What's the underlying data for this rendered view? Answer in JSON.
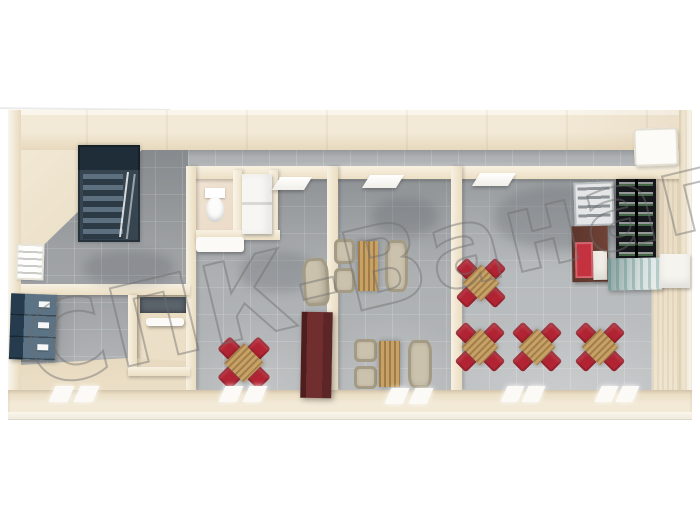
{
  "watermark": {
    "text": "СПК-Ванап"
  },
  "palette": {
    "wall": "#f2e9d6",
    "wallShade": "#e7d9bd",
    "wallRim": "#faf6ec",
    "floor": "#aaadaf",
    "floorDark": "#9b9ea1",
    "floorLight": "#b5b8ba",
    "bath": "#e8d6c2",
    "beigeFloor": "#ecdfc7",
    "stair": "#36454f",
    "stairStep": "#5d7080",
    "locker": "#5b7384",
    "lockerDark": "#263b4d",
    "red": "#b22433",
    "wood": "#c7a267",
    "beige": "#cbc2ad",
    "beigeDark": "#a49b84",
    "cabinet": "#702f2e",
    "shelfDark": "#17181c",
    "fridge": "#e4e6e7",
    "brown": "#6f4236",
    "counter": "#a9bcb9",
    "watermark": "#6e6e6e"
  },
  "scene": {
    "items": [
      {
        "type": "shadow",
        "name": "floor-shadow",
        "x": 495,
        "y": 186,
        "w": 150,
        "h": 64
      },
      {
        "type": "shadow",
        "name": "floor-shadow",
        "x": 372,
        "y": 198,
        "w": 66,
        "h": 38
      },
      {
        "type": "shadow",
        "name": "floor-shadow",
        "x": 240,
        "y": 252,
        "w": 76,
        "h": 40
      },
      {
        "type": "shadow",
        "name": "floor-shadow",
        "x": 84,
        "y": 250,
        "w": 90,
        "h": 36
      },
      {
        "type": "stairs",
        "name": "staircase",
        "x": 78,
        "y": 145,
        "w": 62,
        "h": 97
      },
      {
        "type": "lockers",
        "name": "locker-cabinet",
        "x": 10,
        "y": 294,
        "w": 46,
        "h": 66,
        "t": "rotate(2deg)"
      },
      {
        "type": "window-blinds",
        "name": "left-wall-window",
        "x": 16,
        "y": 244,
        "w": 28,
        "h": 36,
        "t": "rotate(2deg)"
      },
      {
        "type": "mat-dark",
        "name": "vestibule-mat",
        "x": 140,
        "y": 297,
        "w": 46,
        "h": 16
      },
      {
        "type": "bath-counter",
        "name": "vestibule-shelf",
        "x": 146,
        "y": 318,
        "w": 38,
        "h": 8
      },
      {
        "type": "toilet",
        "name": "toilet",
        "x": 204,
        "y": 188,
        "w": 22,
        "h": 34
      },
      {
        "type": "sink-cabinet",
        "name": "washbasin-cabinet",
        "x": 242,
        "y": 174,
        "w": 30,
        "h": 60
      },
      {
        "type": "bath-counter",
        "name": "washroom-counter",
        "x": 196,
        "y": 237,
        "w": 48,
        "h": 15
      },
      {
        "type": "dining-set-red",
        "name": "dining-table-red",
        "x": 215,
        "y": 334,
        "w": 58,
        "h": 58,
        "t": "rotate(45deg)"
      },
      {
        "type": "armchair-beige",
        "name": "armchair",
        "x": 303,
        "y": 258,
        "w": 26,
        "h": 48,
        "t": "rotate(-3deg)"
      },
      {
        "type": "cabinet-red",
        "name": "tall-cabinet",
        "x": 301,
        "y": 312,
        "w": 31,
        "h": 86,
        "t": "rotate(1deg)"
      },
      {
        "type": "dinette",
        "name": "booth-dining-set",
        "x": 334,
        "y": 238,
        "w": 74,
        "h": 56
      },
      {
        "type": "dinette",
        "name": "booth-dining-set",
        "x": 354,
        "y": 338,
        "w": 78,
        "h": 52
      },
      {
        "type": "dining-set-red",
        "name": "dining-table-red",
        "x": 453,
        "y": 255,
        "w": 56,
        "h": 56,
        "t": "rotate(45deg)"
      },
      {
        "type": "dining-set-red",
        "name": "dining-table-red",
        "x": 452,
        "y": 319,
        "w": 56,
        "h": 56,
        "t": "rotate(45deg)"
      },
      {
        "type": "dining-set-red",
        "name": "dining-table-red",
        "x": 509,
        "y": 319,
        "w": 56,
        "h": 56,
        "t": "rotate(45deg)"
      },
      {
        "type": "dining-set-red",
        "name": "dining-table-red",
        "x": 572,
        "y": 319,
        "w": 56,
        "h": 56,
        "t": "rotate(45deg)"
      },
      {
        "type": "fridge-display",
        "name": "drinks-display",
        "x": 574,
        "y": 182,
        "w": 40,
        "h": 44,
        "t": "rotate(-2deg)"
      },
      {
        "type": "shelf-dark",
        "name": "retail-shelf",
        "x": 616,
        "y": 179,
        "w": 40,
        "h": 84
      },
      {
        "type": "shelf-brown",
        "name": "storage-shelf",
        "x": 572,
        "y": 226,
        "w": 36,
        "h": 56,
        "t": "rotate(-1deg)"
      },
      {
        "type": "counter-teal",
        "name": "serving-counter",
        "x": 608,
        "y": 258,
        "w": 54,
        "h": 32,
        "t": "rotate(-1deg)"
      },
      {
        "type": "box-white",
        "name": "counter-block",
        "x": 660,
        "y": 254,
        "w": 30,
        "h": 34
      },
      {
        "type": "ac-panel",
        "name": "wall-panel",
        "x": 634,
        "y": 128,
        "w": 44,
        "h": 38,
        "t": "rotate(-2deg)"
      },
      {
        "type": "door-leaf",
        "name": "open-door",
        "x": 276,
        "y": 177,
        "w": 32,
        "h": 13,
        "t": "skewX(-32deg)"
      },
      {
        "type": "door-leaf",
        "name": "open-door",
        "x": 366,
        "y": 175,
        "w": 34,
        "h": 13,
        "t": "skewX(-32deg)"
      },
      {
        "type": "door-leaf",
        "name": "open-door",
        "x": 476,
        "y": 173,
        "w": 36,
        "h": 13,
        "t": "skewX(-32deg)"
      },
      {
        "type": "threshold",
        "name": "window-light",
        "x": 52,
        "y": 386,
        "w": 44,
        "h": 16,
        "t": "skewX(-24deg)"
      },
      {
        "type": "threshold",
        "name": "window-light",
        "x": 222,
        "y": 386,
        "w": 42,
        "h": 16,
        "t": "skewX(-24deg)"
      },
      {
        "type": "threshold",
        "name": "window-light",
        "x": 388,
        "y": 388,
        "w": 42,
        "h": 16,
        "t": "skewX(-24deg)"
      },
      {
        "type": "threshold",
        "name": "window-light",
        "x": 504,
        "y": 386,
        "w": 38,
        "h": 16,
        "t": "skewX(-24deg)"
      },
      {
        "type": "threshold",
        "name": "window-light",
        "x": 598,
        "y": 386,
        "w": 38,
        "h": 16,
        "t": "skewX(-24deg)"
      }
    ]
  }
}
